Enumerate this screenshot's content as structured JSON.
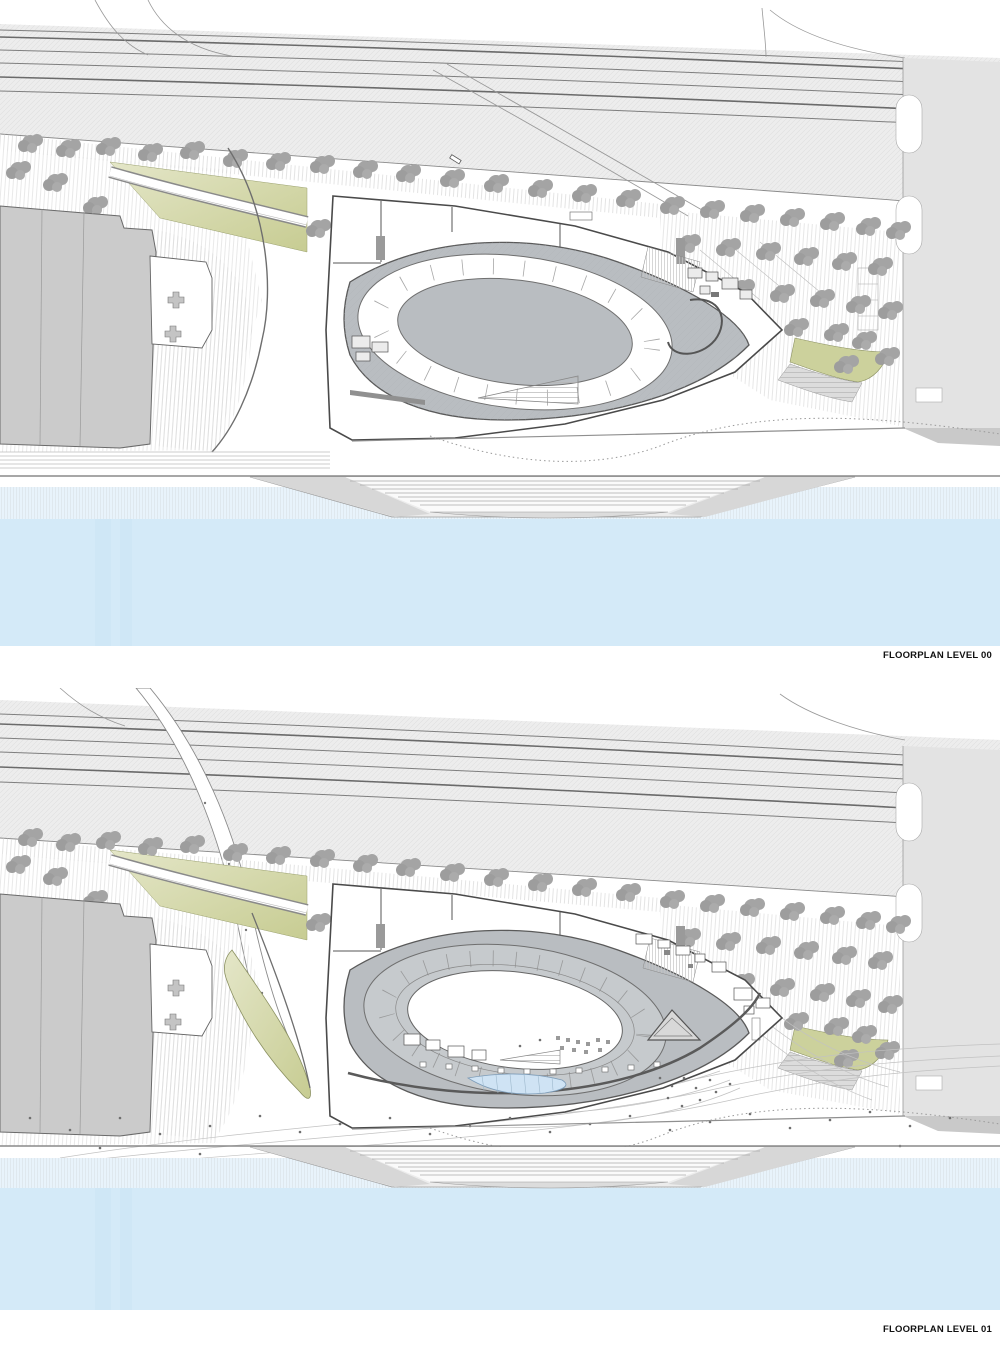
{
  "sheet": {
    "width": 1000,
    "height": 1348,
    "background": "#ffffff",
    "type": "architectural floor plan sheet, two stacked site plans of a riverside arena"
  },
  "panels": [
    {
      "id": "level-00",
      "label": "FLOORPLAN LEVEL 00"
    },
    {
      "id": "level-01",
      "label": "FLOORPLAN LEVEL 01"
    }
  ],
  "palette": {
    "water": "#d4eaf8",
    "water_shallow": "#e8f3fb",
    "rail_corridor": "#ededed",
    "road": "#e3e3e3",
    "existing_building": "#cbcbcb",
    "concourse_gray": "#b9bdc1",
    "seating_gray": "#c6cacd",
    "tree_canopy": "#a4a4a4",
    "landscape_green": "#ccd19c",
    "landscape_green_light": "#e4e6c8",
    "skylight_blue": "#cfe3f4",
    "linework": "#5a5a5a",
    "label_text": "#111111"
  },
  "features": [
    "railway-corridor",
    "street-tree-rows",
    "access-road",
    "pedestrian-bridge-ramp",
    "landscaped-green-wedge",
    "existing-building-block",
    "oval-arena-building",
    "arena-track-ring",
    "parking-grove",
    "riverside-road",
    "terraced-plaza",
    "stepped-quay-pier",
    "river"
  ]
}
